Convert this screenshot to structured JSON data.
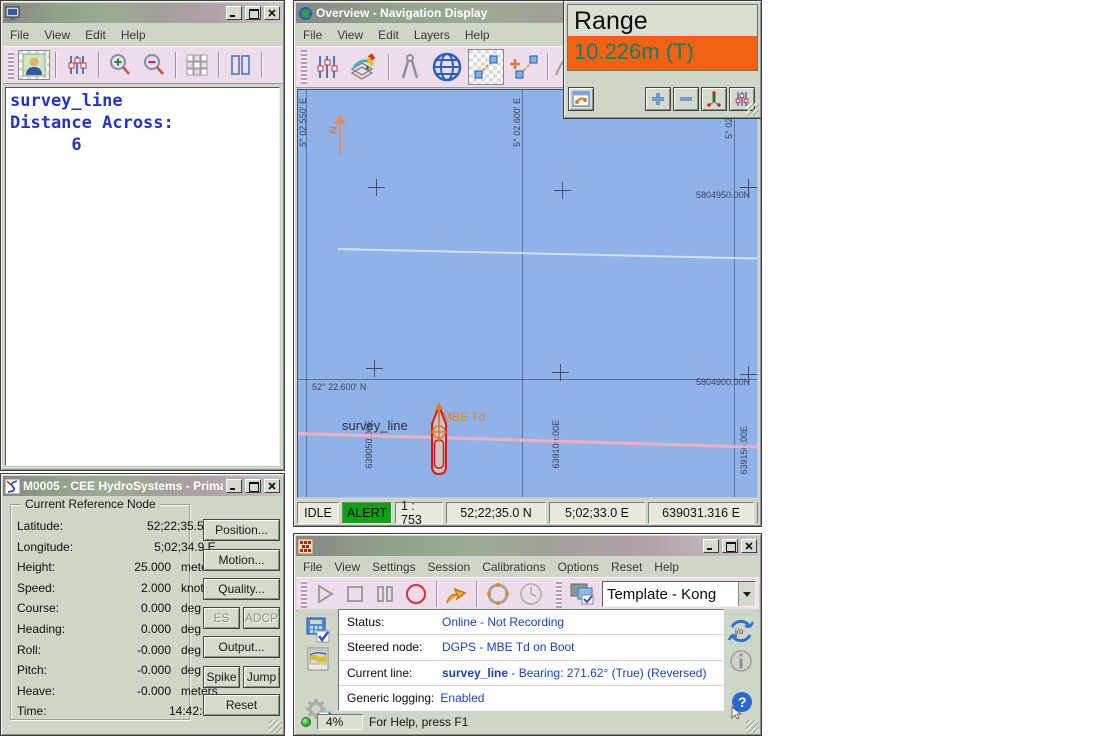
{
  "display_window": {
    "menu": [
      "File",
      "View",
      "Edit",
      "Help"
    ],
    "text_lines": [
      "survey_line",
      "Distance Across:",
      "      6"
    ]
  },
  "m0005_window": {
    "title": "M0005 - CEE HydroSystems - Prima...",
    "group_title": "Current Reference Node",
    "rows": [
      {
        "label": "Latitude:",
        "value": "52;22;35.5 N",
        "unit": ""
      },
      {
        "label": "Longitude:",
        "value": "5;02;34.9 E",
        "unit": ""
      },
      {
        "label": "Height:",
        "value": "25.000",
        "unit": "meters"
      },
      {
        "label": "Speed:",
        "value": "2.000",
        "unit": "knots"
      },
      {
        "label": "Course:",
        "value": "0.000",
        "unit": "deg"
      },
      {
        "label": "Heading:",
        "value": "0.000",
        "unit": "deg"
      },
      {
        "label": "Roll:",
        "value": "-0.000",
        "unit": "deg"
      },
      {
        "label": "Pitch:",
        "value": "-0.000",
        "unit": "deg"
      },
      {
        "label": "Heave:",
        "value": "-0.000",
        "unit": "meters"
      },
      {
        "label": "Time:",
        "value": "14:42:46",
        "unit": ""
      }
    ],
    "buttons": {
      "position": "Position...",
      "motion": "Motion...",
      "quality": "Quality...",
      "es": "ES",
      "adcp": "ADCP",
      "output": "Output...",
      "spike": "Spike",
      "jump": "Jump",
      "reset": "Reset"
    }
  },
  "nav_window": {
    "title": "Overview - Navigation Display",
    "menu": [
      "File",
      "View",
      "Edit",
      "Layers",
      "Help"
    ],
    "map": {
      "lon_labels": [
        "5° 02.550' E",
        "5° 02.600' E",
        "5° 02.650' E"
      ],
      "lat_label": "52° 22.600' N",
      "northing_labels": [
        "5804950.00N",
        "5804900.00N"
      ],
      "easting_labels": [
        "639050.00E",
        "639100.00E",
        "639150.00E"
      ],
      "north_label": "N",
      "survey_line_label": "survey_line",
      "vessel_label": "MBE Td"
    },
    "statusbar": [
      "IDLE",
      "ALERT",
      "1 : 753",
      "52;22;35.0 N",
      "5;02;33.0 E",
      "639031.316 E",
      "5804866.7"
    ]
  },
  "range_window": {
    "title": "Range",
    "value": "10.226m (T)"
  },
  "controller_window": {
    "menu": [
      "File",
      "View",
      "Settings",
      "Session",
      "Calibrations",
      "Options",
      "Reset",
      "Help"
    ],
    "template_combo": "Template - Kong",
    "rows": [
      {
        "label": "Status:",
        "value": "Online - Not Recording"
      },
      {
        "label": "Steered node:",
        "value": "DGPS - MBE Td on Boot"
      },
      {
        "label": "Current line:",
        "value_bold": "survey_line",
        "value_rest": " - Bearing: 271.62° (True) (Reversed)"
      },
      {
        "label": "Generic logging:",
        "value": "Enabled"
      }
    ],
    "statusbar": {
      "progress": "4%",
      "help_text": "For Help, press F1"
    }
  },
  "icons": {
    "io_glyph": "i/o",
    "info_glyph": "i",
    "help_glyph": "?"
  }
}
